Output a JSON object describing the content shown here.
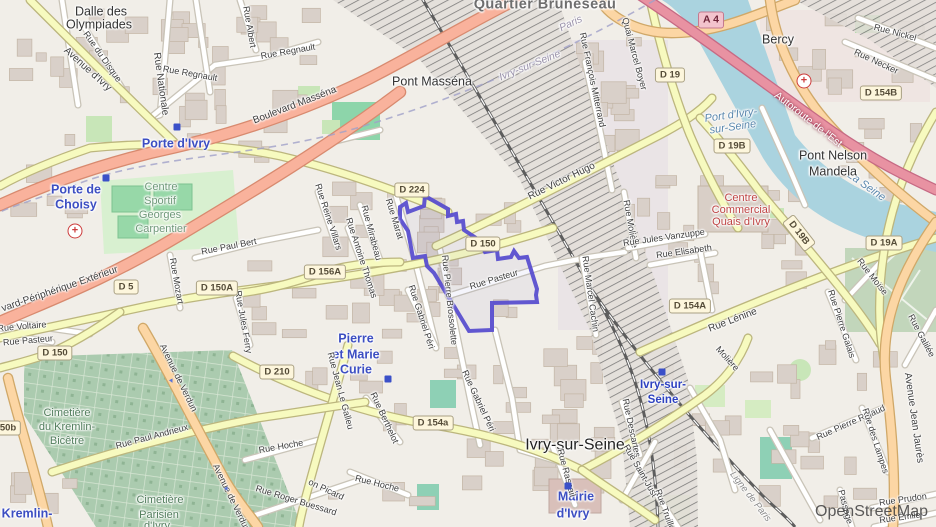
{
  "map": {
    "attribution": "OpenStreetMap",
    "selection_name": "highlighted-district-boundary",
    "colors": {
      "selection": "#5a4fcf",
      "water": "#aad3df",
      "motorway": "#e892a2",
      "trunk": "#f9b29c",
      "primary": "#fcd6a4",
      "secondary": "#f7fabf",
      "park": "#c8e6b8",
      "cemetery": "#abcbaf",
      "building": "#d9d0c9",
      "place_label": "#3c4ec2",
      "shield_bg": "#fdf6dc"
    },
    "labels": [
      {
        "t": "Dalle des",
        "x": 101,
        "y": 12,
        "r": 0,
        "c": "town"
      },
      {
        "t": "Olympiades",
        "x": 99,
        "y": 25,
        "r": 0,
        "c": "town"
      },
      {
        "t": "Avenue d'Ivry",
        "x": 87,
        "y": 70,
        "r": 42,
        "c": "st10"
      },
      {
        "t": "Rue du Disque",
        "x": 102,
        "y": 57,
        "r": 55,
        "c": "st"
      },
      {
        "t": "Rue Nationale",
        "x": 160,
        "y": 84,
        "r": 82,
        "c": "st10"
      },
      {
        "t": "Rue Regnault",
        "x": 190,
        "y": 74,
        "r": 10,
        "c": "st"
      },
      {
        "t": "Rue Albert",
        "x": 249,
        "y": 27,
        "r": 80,
        "c": "st"
      },
      {
        "t": "Rue Regnault",
        "x": 288,
        "y": 52,
        "r": -10,
        "c": "st"
      },
      {
        "t": "Boulevard Masséna",
        "x": 295,
        "y": 106,
        "r": -21,
        "c": "st10"
      },
      {
        "t": "Porte d'Ivry",
        "x": 176,
        "y": 144,
        "r": 0,
        "c": "place"
      },
      {
        "t": "Porte de",
        "x": 76,
        "y": 190,
        "r": 0,
        "c": "place"
      },
      {
        "t": "Choisy",
        "x": 76,
        "y": 205,
        "r": 0,
        "c": "place"
      },
      {
        "t": "Quartier Bruneseau",
        "x": 545,
        "y": 5,
        "r": 0,
        "c": "quarter"
      },
      {
        "t": "Pont Masséna",
        "x": 432,
        "y": 82,
        "r": 0,
        "c": "town"
      },
      {
        "t": "Paris",
        "x": 571,
        "y": 24,
        "r": -25,
        "c": "bound"
      },
      {
        "t": "Ivry-sur-Seine",
        "x": 530,
        "y": 66,
        "r": -22,
        "c": "bound"
      },
      {
        "t": "Rue François Mitterrand",
        "x": 592,
        "y": 80,
        "r": 78,
        "c": "st"
      },
      {
        "t": "Bercy",
        "x": 778,
        "y": 40,
        "r": 0,
        "c": "town"
      },
      {
        "t": "Rue Nickel",
        "x": 895,
        "y": 33,
        "r": 15,
        "c": "st"
      },
      {
        "t": "Rue Necker",
        "x": 876,
        "y": 62,
        "r": 25,
        "c": "st"
      },
      {
        "t": "Quai Marcel Boyer",
        "x": 634,
        "y": 54,
        "r": 75,
        "c": "st"
      },
      {
        "t": "Autoroute de l'Est",
        "x": 808,
        "y": 120,
        "r": 38,
        "c": "mot"
      },
      {
        "t": "Port d'Ivry-",
        "x": 731,
        "y": 116,
        "r": -8,
        "c": "water"
      },
      {
        "t": "sur-Seine",
        "x": 733,
        "y": 128,
        "r": -8,
        "c": "water"
      },
      {
        "t": "La Seine",
        "x": 866,
        "y": 187,
        "r": 35,
        "c": "water"
      },
      {
        "t": "Pont Nelson",
        "x": 833,
        "y": 156,
        "r": 0,
        "c": "town"
      },
      {
        "t": "Mandela",
        "x": 833,
        "y": 172,
        "r": 0,
        "c": "town"
      },
      {
        "t": "Centre",
        "x": 161,
        "y": 188,
        "r": 0,
        "c": "sport"
      },
      {
        "t": "Sportif",
        "x": 160,
        "y": 202,
        "r": 0,
        "c": "sport"
      },
      {
        "t": "Georges",
        "x": 160,
        "y": 216,
        "r": 0,
        "c": "sport"
      },
      {
        "t": "Carpentier",
        "x": 161,
        "y": 230,
        "r": 0,
        "c": "sport"
      },
      {
        "t": "Rue Paul Bert",
        "x": 229,
        "y": 247,
        "r": -11,
        "c": "st"
      },
      {
        "t": "Rue Mozart",
        "x": 176,
        "y": 281,
        "r": 80,
        "c": "st"
      },
      {
        "t": "Rue Jules Ferry",
        "x": 243,
        "y": 322,
        "r": 80,
        "c": "st"
      },
      {
        "t": "vard-Périphérique Extérieur",
        "x": 60,
        "y": 290,
        "r": -19,
        "c": "st10"
      },
      {
        "t": "Rue Voltaire",
        "x": 22,
        "y": 327,
        "r": -5,
        "c": "st"
      },
      {
        "t": "Rue Pasteur",
        "x": 28,
        "y": 341,
        "r": -5,
        "c": "st"
      },
      {
        "t": "Rue Reine Villars",
        "x": 328,
        "y": 217,
        "r": 72,
        "c": "st"
      },
      {
        "t": "Rue Mirabeau",
        "x": 371,
        "y": 233,
        "r": 75,
        "c": "st"
      },
      {
        "t": "Rue Antoine Thomas",
        "x": 361,
        "y": 258,
        "r": 72,
        "c": "st"
      },
      {
        "t": "Rue Marat",
        "x": 394,
        "y": 219,
        "r": 73,
        "c": "st"
      },
      {
        "t": "Rue Gabriel Péri",
        "x": 421,
        "y": 317,
        "r": 72,
        "c": "st"
      },
      {
        "t": "Rue Pierre Brossolette",
        "x": 449,
        "y": 300,
        "r": 84,
        "c": "st"
      },
      {
        "t": "Rue Pasteur",
        "x": 494,
        "y": 280,
        "r": -17,
        "c": "st"
      },
      {
        "t": "Rue Victor Hugo",
        "x": 562,
        "y": 182,
        "r": -26,
        "c": "st10"
      },
      {
        "t": "Rue Marcel Cachin",
        "x": 590,
        "y": 294,
        "r": 82,
        "c": "st"
      },
      {
        "t": "Rue Molière",
        "x": 630,
        "y": 224,
        "r": 80,
        "c": "st"
      },
      {
        "t": "Rue Jules Vanzuppe",
        "x": 664,
        "y": 238,
        "r": -8,
        "c": "st"
      },
      {
        "t": "Rue Elisabeth",
        "x": 684,
        "y": 252,
        "r": -8,
        "c": "st"
      },
      {
        "t": "Centre",
        "x": 741,
        "y": 199,
        "r": 0,
        "c": "red"
      },
      {
        "t": "Commercial",
        "x": 741,
        "y": 211,
        "r": 0,
        "c": "red"
      },
      {
        "t": "Quais d'Ivry",
        "x": 741,
        "y": 223,
        "r": 0,
        "c": "red"
      },
      {
        "t": "Rue Lénine",
        "x": 733,
        "y": 321,
        "r": -21,
        "c": "st10"
      },
      {
        "t": "Rue Moïse",
        "x": 872,
        "y": 277,
        "r": 52,
        "c": "st"
      },
      {
        "t": "Rue Pierre Galais",
        "x": 841,
        "y": 324,
        "r": 72,
        "c": "st"
      },
      {
        "t": "Rue Galilée",
        "x": 921,
        "y": 336,
        "r": 62,
        "c": "st"
      },
      {
        "t": "Pierre",
        "x": 356,
        "y": 339,
        "r": 0,
        "c": "place"
      },
      {
        "t": "et Marie",
        "x": 356,
        "y": 355,
        "r": 0,
        "c": "place"
      },
      {
        "t": "Curie",
        "x": 356,
        "y": 370,
        "r": 0,
        "c": "place"
      },
      {
        "t": "Avenue de Verdun",
        "x": 178,
        "y": 378,
        "r": 64,
        "c": "st"
      },
      {
        "t": "Avenue de Verdun",
        "x": 231,
        "y": 498,
        "r": 64,
        "c": "st"
      },
      {
        "t": "Rue Paul Andrieux",
        "x": 152,
        "y": 437,
        "r": -15,
        "c": "st"
      },
      {
        "t": "Cimetière",
        "x": 67,
        "y": 414,
        "r": 0,
        "c": "green"
      },
      {
        "t": "du Kremlin-",
        "x": 67,
        "y": 428,
        "r": 0,
        "c": "green"
      },
      {
        "t": "Bicêtre",
        "x": 67,
        "y": 442,
        "r": 0,
        "c": "green"
      },
      {
        "t": "Cimetière",
        "x": 160,
        "y": 501,
        "r": 0,
        "c": "green"
      },
      {
        "t": "Parisien",
        "x": 159,
        "y": 516,
        "r": 0,
        "c": "green"
      },
      {
        "t": "d'Ivry",
        "x": 157,
        "y": 527,
        "r": 0,
        "c": "green"
      },
      {
        "t": "Le Kremlin-",
        "x": 18,
        "y": 514,
        "r": 0,
        "c": "place"
      },
      {
        "t": "Rue Hoche",
        "x": 281,
        "y": 447,
        "r": -10,
        "c": "st"
      },
      {
        "t": "Rue Hoche",
        "x": 377,
        "y": 484,
        "r": 14,
        "c": "st"
      },
      {
        "t": "Rue Roger Buessard",
        "x": 296,
        "y": 501,
        "r": 17,
        "c": "st"
      },
      {
        "t": "on Picard",
        "x": 326,
        "y": 490,
        "r": 25,
        "c": "st"
      },
      {
        "t": "Rue Jean Le Galleu",
        "x": 340,
        "y": 391,
        "r": 75,
        "c": "st"
      },
      {
        "t": "Rue Berthelot",
        "x": 384,
        "y": 418,
        "r": 65,
        "c": "st"
      },
      {
        "t": "Rue Gabriel Péri",
        "x": 478,
        "y": 401,
        "r": 65,
        "c": "st"
      },
      {
        "t": "Ivry-sur-Seine",
        "x": 575,
        "y": 446,
        "r": 0,
        "c": "city"
      },
      {
        "t": "Mairie",
        "x": 576,
        "y": 497,
        "r": 0,
        "c": "place"
      },
      {
        "t": "d'Ivry",
        "x": 573,
        "y": 514,
        "r": 0,
        "c": "place"
      },
      {
        "t": "Rue Raspail",
        "x": 566,
        "y": 473,
        "r": 75,
        "c": "st"
      },
      {
        "t": "Ivry-sur-",
        "x": 663,
        "y": 385,
        "r": 0,
        "c": "station"
      },
      {
        "t": "Seine",
        "x": 663,
        "y": 400,
        "r": 0,
        "c": "station"
      },
      {
        "t": "Rue Descartes",
        "x": 631,
        "y": 428,
        "r": 78,
        "c": "st"
      },
      {
        "t": "Rue Saint-Just",
        "x": 640,
        "y": 471,
        "r": 60,
        "c": "st"
      },
      {
        "t": "Rue Truillot",
        "x": 665,
        "y": 511,
        "r": 70,
        "c": "st"
      },
      {
        "t": "Molière",
        "x": 727,
        "y": 359,
        "r": 48,
        "c": "st"
      },
      {
        "t": "Ligne de Paris",
        "x": 750,
        "y": 497,
        "r": 52,
        "c": "rail"
      },
      {
        "t": "Rue Pierre Rigaud",
        "x": 851,
        "y": 423,
        "r": -24,
        "c": "st"
      },
      {
        "t": "Rue des Lampes",
        "x": 875,
        "y": 441,
        "r": 72,
        "c": "st"
      },
      {
        "t": "Avenue Jean Jaurès",
        "x": 913,
        "y": 418,
        "r": 82,
        "c": "st10"
      },
      {
        "t": "Rue Prudon",
        "x": 903,
        "y": 500,
        "r": -8,
        "c": "st"
      },
      {
        "t": "Rue Émile",
        "x": 900,
        "y": 518,
        "r": -8,
        "c": "st"
      },
      {
        "t": "Passage",
        "x": 845,
        "y": 507,
        "r": 75,
        "c": "st"
      }
    ],
    "shields": [
      {
        "t": "A 4",
        "x": 711,
        "y": 20,
        "r": 0,
        "a": true
      },
      {
        "t": "D 19",
        "x": 670,
        "y": 75,
        "r": 0
      },
      {
        "t": "D 19B",
        "x": 732,
        "y": 146,
        "r": 0
      },
      {
        "t": "D 19B",
        "x": 799,
        "y": 233,
        "r": 52
      },
      {
        "t": "D 154B",
        "x": 881,
        "y": 93,
        "r": 0
      },
      {
        "t": "D 19A",
        "x": 884,
        "y": 243,
        "r": 0
      },
      {
        "t": "D 224",
        "x": 412,
        "y": 190,
        "r": 0
      },
      {
        "t": "D 150",
        "x": 483,
        "y": 244,
        "r": 0
      },
      {
        "t": "D 156A",
        "x": 325,
        "y": 272,
        "r": 0
      },
      {
        "t": "D 150A",
        "x": 217,
        "y": 288,
        "r": 0
      },
      {
        "t": "D 5",
        "x": 126,
        "y": 287,
        "r": 0
      },
      {
        "t": "D 150",
        "x": 55,
        "y": 353,
        "r": 0
      },
      {
        "t": "D 210",
        "x": 277,
        "y": 372,
        "r": 0
      },
      {
        "t": "D 154a",
        "x": 433,
        "y": 423,
        "r": 0
      },
      {
        "t": "D 154A",
        "x": 690,
        "y": 306,
        "r": 0
      },
      {
        "t": "50b",
        "x": 8,
        "y": 428,
        "r": 0
      }
    ],
    "icons": [
      {
        "n": "hospital",
        "x": 75,
        "y": 231
      },
      {
        "n": "hospital",
        "x": 804,
        "y": 81
      },
      {
        "n": "metro",
        "x": 177,
        "y": 127
      },
      {
        "n": "metro",
        "x": 106,
        "y": 178
      },
      {
        "n": "metro",
        "x": 388,
        "y": 379
      },
      {
        "n": "metro",
        "x": 662,
        "y": 372
      },
      {
        "n": "metro",
        "x": 568,
        "y": 486
      },
      {
        "n": "arrow",
        "x": 172,
        "y": 381,
        "r": 64
      },
      {
        "n": "arrow",
        "x": 227,
        "y": 489,
        "r": 64
      }
    ]
  }
}
